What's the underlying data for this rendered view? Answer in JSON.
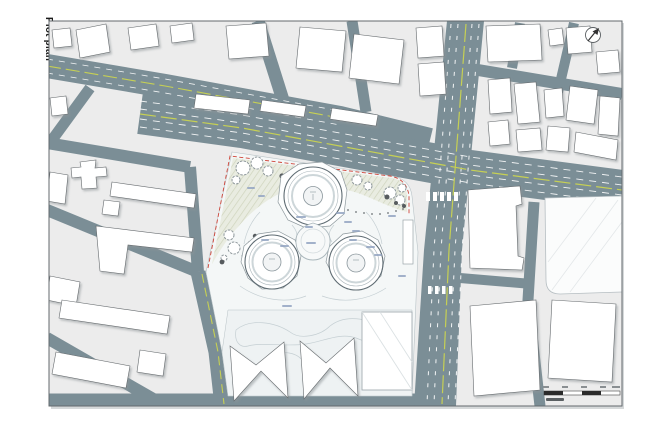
{
  "page": {
    "background": "#ffffff"
  },
  "drawing": {
    "title": "Plot plan",
    "kind": "architectural site plan",
    "colors": {
      "road": "#7b8e96",
      "lane_yellow": "#c6d054",
      "lane_white": "#ffffff",
      "block_ground": "#ececec",
      "site_ground": "#f4f7f7",
      "garden_ground": "#eef2f3",
      "landscape_hatch": "#cfd4bd",
      "building_fill": "#ffffff",
      "building_outline": "#666b6e",
      "site_boundary_red": "#cf4539",
      "tree_dark": "#565b5e",
      "frame": "#63696d",
      "annotation_blue": "#93a5c2"
    },
    "icons": {
      "north_arrow": "north-arrow-icon",
      "scale_bar": "scale-bar"
    },
    "features": {
      "towers_count": 3
    }
  }
}
